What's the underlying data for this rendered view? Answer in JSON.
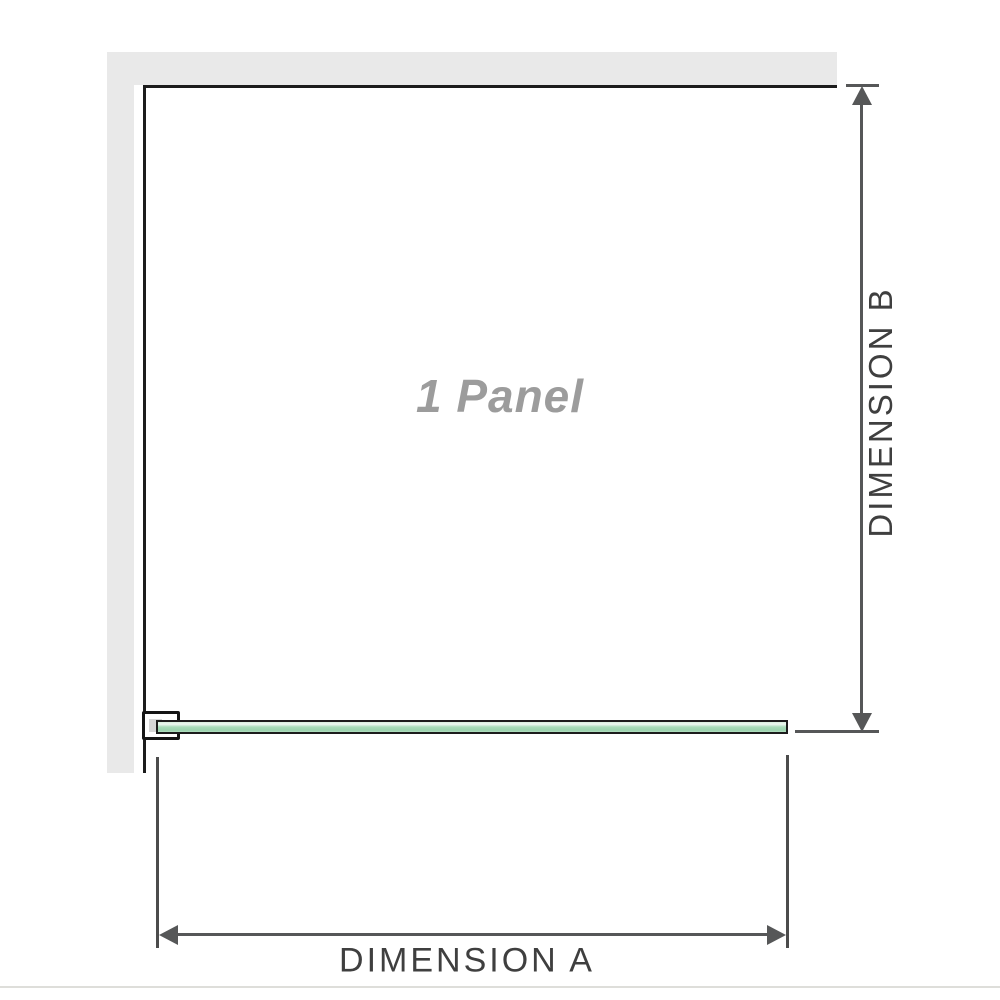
{
  "diagram": {
    "title": "1 panel shower screen dimension diagram",
    "panel_label": "1 Panel",
    "panel_count": 1,
    "dimension_a": {
      "label": "DIMENSION A",
      "orientation": "horizontal",
      "measures": "panel width along glass bar"
    },
    "dimension_b": {
      "label": "DIMENSION B",
      "orientation": "vertical",
      "measures": "panel height from wall to glass bar"
    }
  },
  "colors": {
    "wall_fill": "#e9e9e9",
    "outline_black": "#1c1c1c",
    "dimension_line": "#565758",
    "label_text": "#3f3f3f",
    "panel_label_text": "#9c9c9c",
    "glass_green_mid": "#a9dcba",
    "glass_green_light": "#eef8f1",
    "glass_green_dark": "#9bd3ae",
    "bracket_inner_gray": "#d6d6d6",
    "ground_line": "#dededa"
  }
}
